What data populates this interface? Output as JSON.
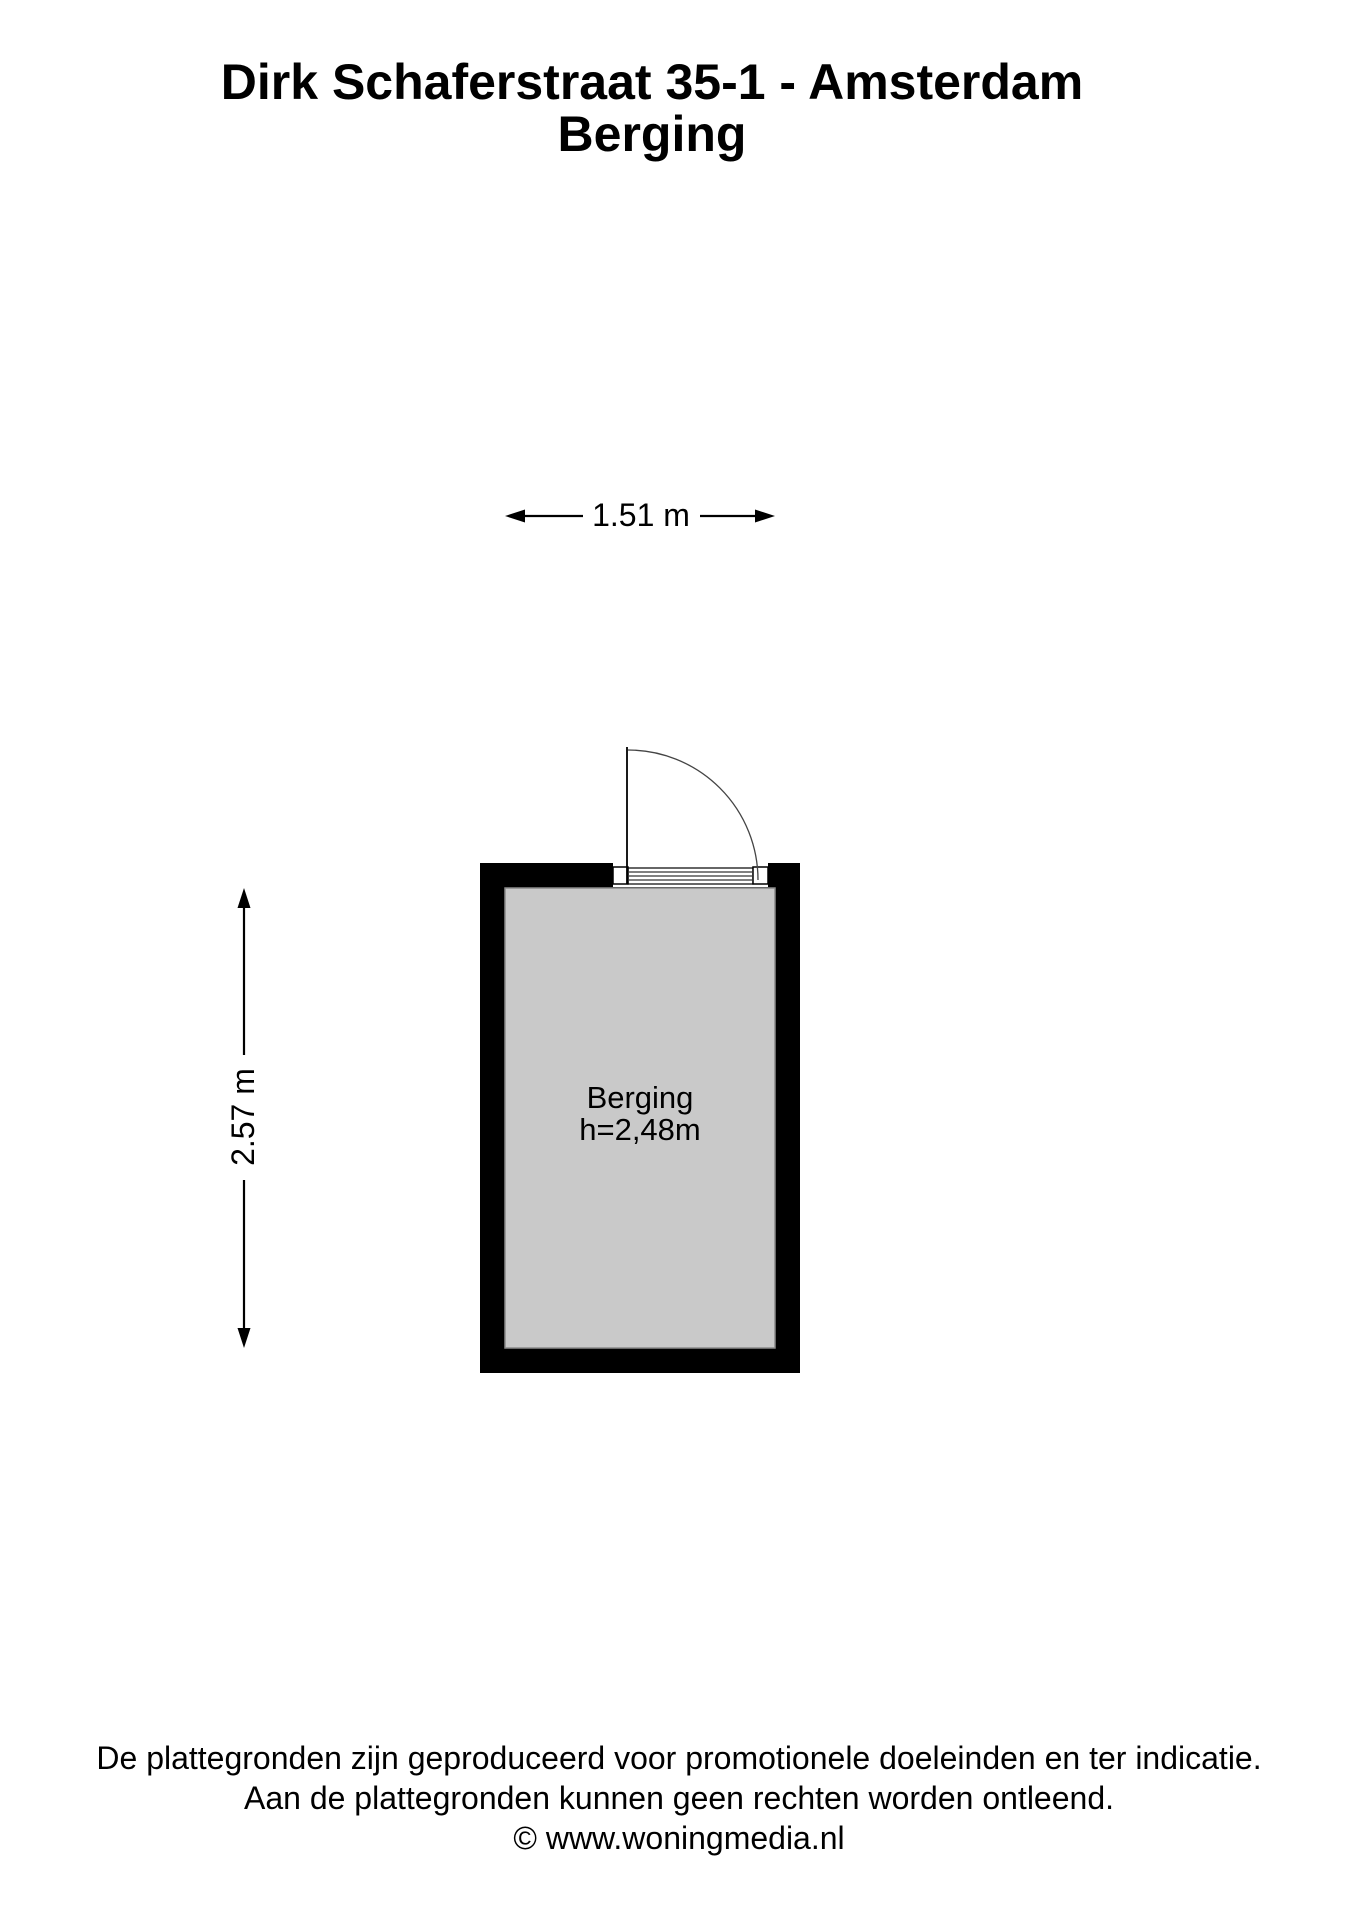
{
  "title": {
    "line1": "Dirk Schaferstraat 35-1 - Amsterdam",
    "line2": "Berging"
  },
  "floorplan": {
    "room": {
      "name": "Berging",
      "ceiling_height": "h=2,48m"
    },
    "dimensions": {
      "width_label": "1.51 m",
      "height_label": "2.57 m"
    }
  },
  "footer": {
    "line1": "De plattegronden zijn geproduceerd voor promotionele doeleinden en ter indicatie.",
    "line2": "Aan de plattegronden kunnen geen rechten worden ontleend.",
    "line3": "© www.woningmedia.nl"
  },
  "colors": {
    "wall": "#000000",
    "floor": "#c9c9c9",
    "floor_border": "#8a8a8a",
    "line": "#000000",
    "arc": "#444444"
  }
}
